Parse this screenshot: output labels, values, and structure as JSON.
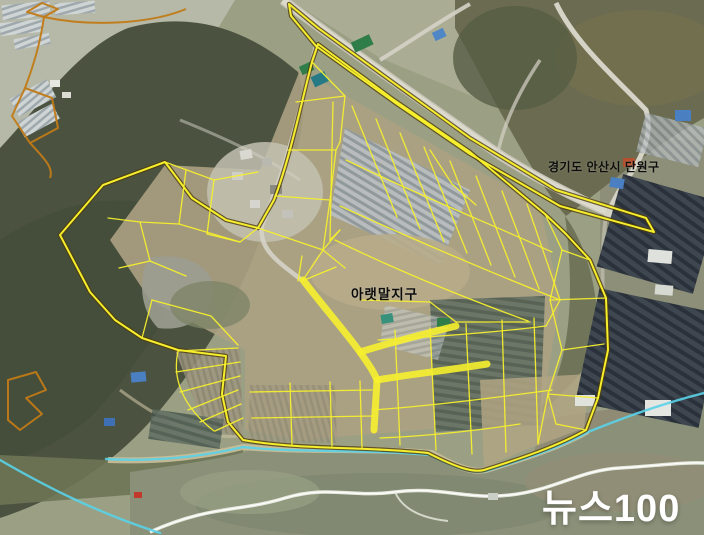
{
  "map": {
    "type": "satellite-cadastral-photo",
    "labels": {
      "region": "경기도 안산시 단원구",
      "district": "아랫말지구",
      "watermark": "뉴스100"
    },
    "colors": {
      "parcel_boundary": "#f6ef2d",
      "district_casing": "#4d3c0c",
      "adjacent_boundary_orange": "#c17a16",
      "waterline_cyan": "#5ad2e8",
      "label_text": "#0d0d0d",
      "watermark_text": "#ffffff"
    },
    "overlay": {
      "road_strip": "M289,4 L318,28 L398,86 L470,138 L556,190 L646,218 L654,232 L560,206 L470,154 L394,102 L316,46 L291,16 Z",
      "district_boundary": "M312,62 C300,108 290,158 274,200 L258,228 L226,220 L192,198 L165,162 L103,185 L60,235 L90,292 L115,320 L142,338 L178,350 L226,356 L222,394 L228,422 L243,440 C300,450 360,446 428,453 C456,467 472,473 484,470 C522,458 558,446 586,430 L598,398 L608,350 L606,298 L590,260 L566,234 L545,214 L470,152 L394,100 L318,44 Z",
      "road_fills": [
        "M303,280 C322,305 344,330 360,352 C369,365 374,372 377,380",
        "M377,380 C412,374 450,370 487,364",
        "M360,352 C392,342 424,334 456,326",
        "M377,380 L374,430"
      ],
      "parcel_lines": [
        "M312,62 L345,96 L340,142",
        "M296,102 L345,96",
        "M288,150 L336,150",
        "M340,142 L336,150 L330,200",
        "M276,196 L330,200",
        "M330,200 L323,250",
        "M258,228 L323,250 L345,268",
        "M302,256 L298,281",
        "M323,250 L303,280",
        "M165,162 L214,180 L258,172",
        "M214,180 L207,234",
        "M186,170 L179,224",
        "M179,224 L240,242",
        "M207,234 L240,242 L258,228",
        "M140,222 L179,224",
        "M108,218 L140,222",
        "M140,222 L150,261 L186,276",
        "M150,261 L119,268",
        "M152,300 L211,316 L238,345",
        "M152,300 L142,338",
        "M333,102 L330,240 L340,230",
        "M352,106 L397,217",
        "M376,119 L420,229",
        "M400,133 L444,242",
        "M424,147 L467,253",
        "M450,161 L491,265",
        "M476,176 L515,277",
        "M502,191 L539,289",
        "M527,204 L560,300",
        "M340,206 C410,238 480,268 560,300",
        "M346,160 C420,196 498,227 552,252",
        "M335,240 C400,272 468,299 528,321",
        "M340,230 L323,250",
        "M430,150 L452,184",
        "M452,184 L476,205",
        "M302,281 L336,267",
        "M360,300 L430,302",
        "M430,302 L456,322",
        "M456,322 L530,322",
        "M395,330 L400,445",
        "M430,328 L436,450",
        "M466,324 L472,454",
        "M502,320 L506,452",
        "M534,318 L538,444",
        "M378,340 C432,337 490,333 546,326",
        "M372,410 C430,406 492,398 552,390",
        "M380,438 C430,436 480,430 520,424",
        "M560,300 L546,326",
        "M545,214 L562,250",
        "M562,250 L550,300",
        "M550,300 L562,350",
        "M562,350 L548,394",
        "M548,394 L556,424",
        "M562,250 L590,260",
        "M550,300 L606,298",
        "M562,350 L604,344",
        "M548,394 L598,398",
        "M556,424 L586,430",
        "M538,444 L548,394",
        "M238,348 L178,351",
        "M240,362 L176,372",
        "M240,376 L180,392",
        "M238,390 L188,410",
        "M241,404 L200,422",
        "M243,418 L215,431",
        "M178,351 C172,378 182,406 214,431",
        "M250,392 L372,390",
        "M252,418 L374,416",
        "M290,383 L292,445",
        "M330,382 L332,446",
        "M360,381 L362,448"
      ],
      "orange_lines": [
        "M27,12 L42,3 L58,9 L44,17 Z",
        "M44,17 C90,27 150,24 186,9",
        "M44,17 C40,44 34,64 25,88",
        "M25,88 L52,98 L58,128 L30,143 L12,116 Z",
        "M30,143 C44,158 54,168 50,178",
        "M8,380 L36,372 L46,390 L26,398 L42,414 L20,430 L8,420 Z"
      ],
      "cyan_lines": [
        "M106,459 C160,462 205,456 243,447 C300,453 365,449 430,455 C457,469 473,474 486,471 C524,459 560,448 588,432 C620,419 664,403 704,393",
        "M0,460 C45,486 95,512 160,533"
      ]
    }
  }
}
